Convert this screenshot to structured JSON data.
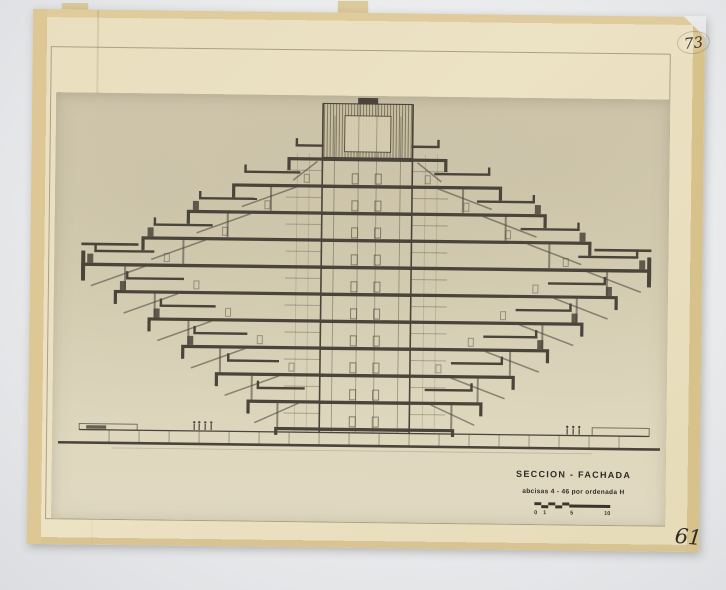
{
  "annotations": {
    "top_right_number": "73",
    "bottom_right_number": "61"
  },
  "title_block": {
    "title": "SECCION - FACHADA",
    "subtitle": "abcisas 4 - 46 por ordenada H",
    "scale_labels": [
      "0",
      "1",
      "5",
      "10"
    ]
  },
  "colors": {
    "background": "#ebecee",
    "paper": "#e9dfbf",
    "print_area": "#d8cfb4",
    "ink": "#4b443a"
  }
}
